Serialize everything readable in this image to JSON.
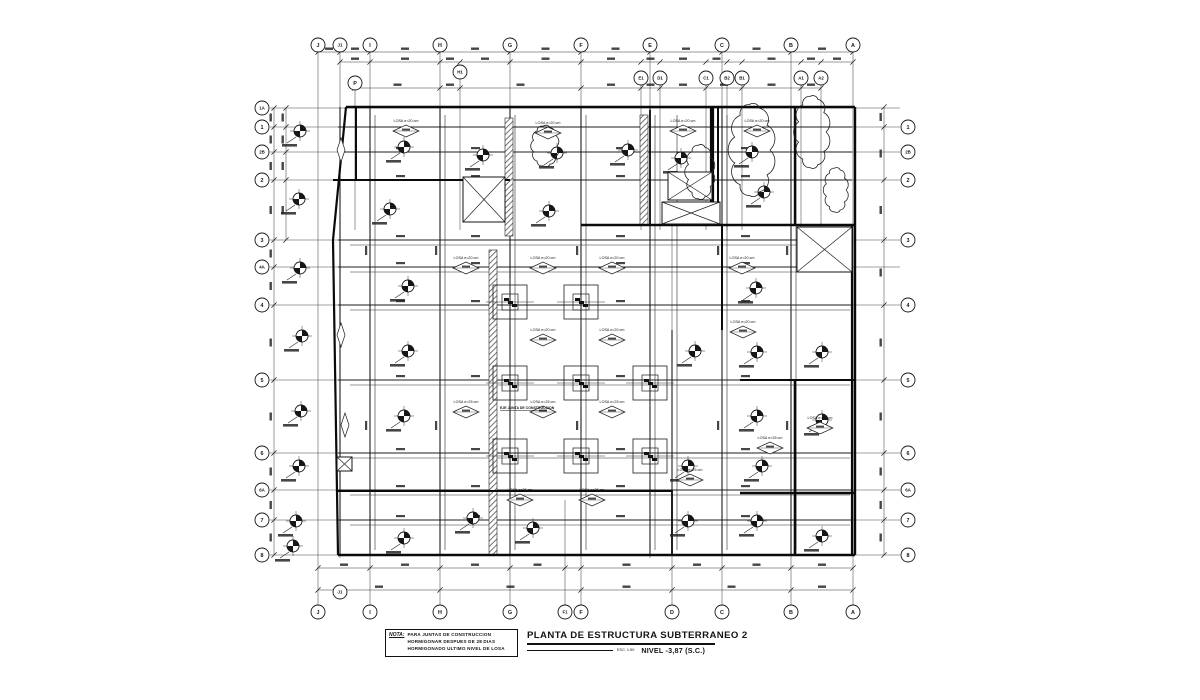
{
  "sheet": {
    "paper": "#ffffff",
    "ink": "#161616",
    "thin": "#454545",
    "hatch": "#5a5a5a"
  },
  "title_block": {
    "title": "PLANTA DE ESTRUCTURA SUBTERRANEO 2",
    "scale": "ESC. 1:50",
    "level": "NIVEL -3,87 (S.C.)"
  },
  "note": {
    "label": "NOTA:",
    "lines": [
      "PARA JUNTAS DE CONSTRUCCION",
      "HORMIGONAR DESPUES DE 28 DIAS",
      "HORMIGONADO ULTIMO NIVEL DE LOSA"
    ]
  },
  "annotations": {
    "slab_20": "LOSA e=20 cm",
    "slab_25": "LOSA e=25 cm",
    "joint_axis": "EJE JUNTA DE CONSTRUCCION"
  },
  "grid": {
    "columns": [
      {
        "label": "J",
        "x": 318,
        "top": true,
        "bottom": true
      },
      {
        "label": "J1",
        "x": 340,
        "top": true,
        "bottom": false
      },
      {
        "label": "I",
        "x": 370,
        "top": true,
        "bottom": true
      },
      {
        "label": "H",
        "x": 440,
        "top": true,
        "bottom": true
      },
      {
        "label": "G",
        "x": 510,
        "top": true,
        "bottom": true
      },
      {
        "label": "F1",
        "x": 565,
        "top": false,
        "bottom": true
      },
      {
        "label": "F",
        "x": 581,
        "top": true,
        "bottom": true
      },
      {
        "label": "E",
        "x": 650,
        "top": true,
        "bottom": false
      },
      {
        "label": "D",
        "x": 672,
        "top": false,
        "bottom": true
      },
      {
        "label": "C",
        "x": 722,
        "top": true,
        "bottom": true
      },
      {
        "label": "B",
        "x": 791,
        "top": true,
        "bottom": true
      },
      {
        "label": "A",
        "x": 853,
        "top": true,
        "bottom": true
      }
    ],
    "columns_secondary": [
      {
        "label": "P",
        "x": 355,
        "y": 83
      },
      {
        "label": "H1",
        "x": 460,
        "y": 72
      },
      {
        "label": "E1",
        "x": 641,
        "y": 78
      },
      {
        "label": "D1",
        "x": 660,
        "y": 78
      },
      {
        "label": "C1",
        "x": 706,
        "y": 78
      },
      {
        "label": "B2",
        "x": 727,
        "y": 78
      },
      {
        "label": "B1",
        "x": 742,
        "y": 78
      },
      {
        "label": "A1",
        "x": 801,
        "y": 78
      },
      {
        "label": "A2",
        "x": 821,
        "y": 78
      }
    ],
    "rows": [
      {
        "label": "1A",
        "y": 108,
        "left": true,
        "right": false
      },
      {
        "label": "1",
        "y": 127,
        "left": true,
        "right": true
      },
      {
        "label": "2B",
        "y": 152,
        "left": true,
        "right": true
      },
      {
        "label": "2",
        "y": 180,
        "left": true,
        "right": true
      },
      {
        "label": "3",
        "y": 240,
        "left": true,
        "right": true
      },
      {
        "label": "4A",
        "y": 267,
        "left": true,
        "right": false
      },
      {
        "label": "4",
        "y": 305,
        "left": true,
        "right": true
      },
      {
        "label": "5",
        "y": 380,
        "left": true,
        "right": true
      },
      {
        "label": "6",
        "y": 453,
        "left": true,
        "right": true
      },
      {
        "label": "6A",
        "y": 490,
        "left": true,
        "right": true
      },
      {
        "label": "7",
        "y": 520,
        "left": true,
        "right": true
      },
      {
        "label": "8",
        "y": 555,
        "left": true,
        "right": true
      }
    ],
    "extra_bottom_bubble": {
      "label": "J1",
      "x": 340,
      "y": 592
    }
  },
  "elements": {
    "outline": [
      [
        346,
        107,
        855,
        107,
        2.4
      ],
      [
        855,
        107,
        855,
        555,
        2.4
      ],
      [
        338,
        555,
        855,
        555,
        2.4
      ],
      [
        346,
        107,
        333,
        240,
        2.2
      ],
      [
        333,
        240,
        338,
        555,
        2.2
      ]
    ],
    "walls": [
      [
        712,
        107,
        712,
        225,
        4.2
      ],
      [
        718,
        107,
        718,
        225,
        2.0
      ],
      [
        795,
        107,
        795,
        225,
        2.4
      ],
      [
        795,
        380,
        795,
        555,
        2.6
      ],
      [
        581,
        225,
        855,
        225,
        2.4
      ],
      [
        740,
        493,
        855,
        493,
        2.4
      ],
      [
        333,
        180,
        510,
        180,
        2.0
      ],
      [
        852,
        225,
        852,
        555,
        2.2
      ],
      [
        356,
        107,
        356,
        180,
        2.0
      ],
      [
        650,
        110,
        650,
        225,
        1.8
      ],
      [
        722,
        225,
        722,
        330,
        2.0
      ],
      [
        740,
        380,
        855,
        380,
        2.0
      ],
      [
        338,
        491,
        672,
        491,
        2.0
      ],
      [
        672,
        490,
        672,
        555,
        1.8
      ]
    ],
    "beam_cols": [
      340,
      370,
      440,
      510,
      581,
      650,
      672,
      722,
      791
    ],
    "beam_rows": [
      127,
      152,
      180,
      240,
      267,
      305,
      380,
      453,
      490,
      520
    ],
    "columns": [
      [
        300,
        131
      ],
      [
        299,
        199
      ],
      [
        300,
        268
      ],
      [
        302,
        336
      ],
      [
        301,
        411
      ],
      [
        299,
        466
      ],
      [
        296,
        521
      ],
      [
        293,
        546
      ],
      [
        404,
        147
      ],
      [
        483,
        155
      ],
      [
        557,
        153
      ],
      [
        628,
        150
      ],
      [
        681,
        158
      ],
      [
        752,
        152
      ],
      [
        390,
        209
      ],
      [
        549,
        211
      ],
      [
        764,
        192
      ],
      [
        408,
        286
      ],
      [
        756,
        288
      ],
      [
        408,
        351
      ],
      [
        695,
        351
      ],
      [
        757,
        352
      ],
      [
        822,
        352
      ],
      [
        404,
        416
      ],
      [
        757,
        416
      ],
      [
        822,
        420
      ],
      [
        688,
        466
      ],
      [
        762,
        466
      ],
      [
        473,
        518
      ],
      [
        533,
        528
      ],
      [
        688,
        521
      ],
      [
        757,
        521
      ],
      [
        822,
        536
      ],
      [
        404,
        538
      ]
    ],
    "footings": [
      [
        510,
        302
      ],
      [
        581,
        302
      ],
      [
        510,
        383
      ],
      [
        581,
        383
      ],
      [
        650,
        383
      ],
      [
        510,
        456
      ],
      [
        581,
        456
      ],
      [
        650,
        456
      ]
    ],
    "slab_tags": [
      [
        406,
        131,
        "20"
      ],
      [
        548,
        133,
        "20"
      ],
      [
        683,
        131,
        "20"
      ],
      [
        757,
        131,
        "20"
      ],
      [
        466,
        268,
        "20"
      ],
      [
        543,
        268,
        "20"
      ],
      [
        612,
        268,
        "20"
      ],
      [
        742,
        268,
        "20"
      ],
      [
        543,
        340,
        "20"
      ],
      [
        612,
        340,
        "20"
      ],
      [
        743,
        332,
        "20"
      ],
      [
        466,
        412,
        "25"
      ],
      [
        543,
        412,
        "25"
      ],
      [
        612,
        412,
        "25"
      ],
      [
        520,
        500,
        "25"
      ],
      [
        592,
        500,
        "25"
      ],
      [
        690,
        480,
        "25"
      ],
      [
        770,
        448,
        "25"
      ],
      [
        820,
        428,
        "25"
      ]
    ],
    "vertical_diamonds": [
      [
        341,
        150
      ],
      [
        341,
        335
      ],
      [
        345,
        425
      ]
    ],
    "openings": [
      [
        463,
        177,
        42,
        45
      ],
      [
        668,
        172,
        44,
        28
      ],
      [
        662,
        202,
        58,
        22
      ],
      [
        797,
        227,
        55,
        45
      ],
      [
        337,
        457,
        15,
        14
      ]
    ],
    "joints": [
      [
        489,
        250,
        8,
        305
      ],
      [
        505,
        118,
        8,
        118
      ],
      [
        640,
        115,
        8,
        110
      ]
    ],
    "joint_axis_pos": [
      500,
      409
    ],
    "clouds": [
      [
        752,
        150,
        18,
        46
      ],
      [
        812,
        132,
        14,
        36
      ],
      [
        700,
        172,
        12,
        27
      ],
      [
        545,
        146,
        12,
        20
      ],
      [
        836,
        190,
        10,
        22
      ]
    ],
    "dims": {
      "top1_y": 52,
      "top1_ticks": [
        318,
        340,
        370,
        440,
        510,
        581,
        650,
        722,
        791,
        853
      ],
      "top2_y": 62,
      "top2_ticks": [
        340,
        370,
        440,
        460,
        510,
        581,
        641,
        660,
        706,
        727,
        742,
        801,
        821,
        853
      ],
      "top3_y": 88,
      "top3_ticks": [
        355,
        440,
        460,
        581,
        641,
        660,
        706,
        742,
        801,
        821
      ],
      "left1_x": 274,
      "left1_ticks": [
        108,
        127,
        152,
        180,
        240,
        267,
        305,
        380,
        453,
        490,
        520,
        555
      ],
      "left2_x": 286,
      "left2_ticks": [
        108,
        127,
        152,
        180,
        240
      ],
      "bottom1_y": 568,
      "bottom1_ticks": [
        318,
        370,
        440,
        510,
        565,
        581,
        672,
        722,
        791,
        853
      ],
      "bottom2_y": 590,
      "bottom2_ticks": [
        318,
        440,
        581,
        672,
        791,
        853
      ],
      "right_x": 884,
      "right_ticks": [
        107,
        127,
        180,
        240,
        305,
        380,
        453,
        490,
        520,
        555
      ]
    }
  }
}
